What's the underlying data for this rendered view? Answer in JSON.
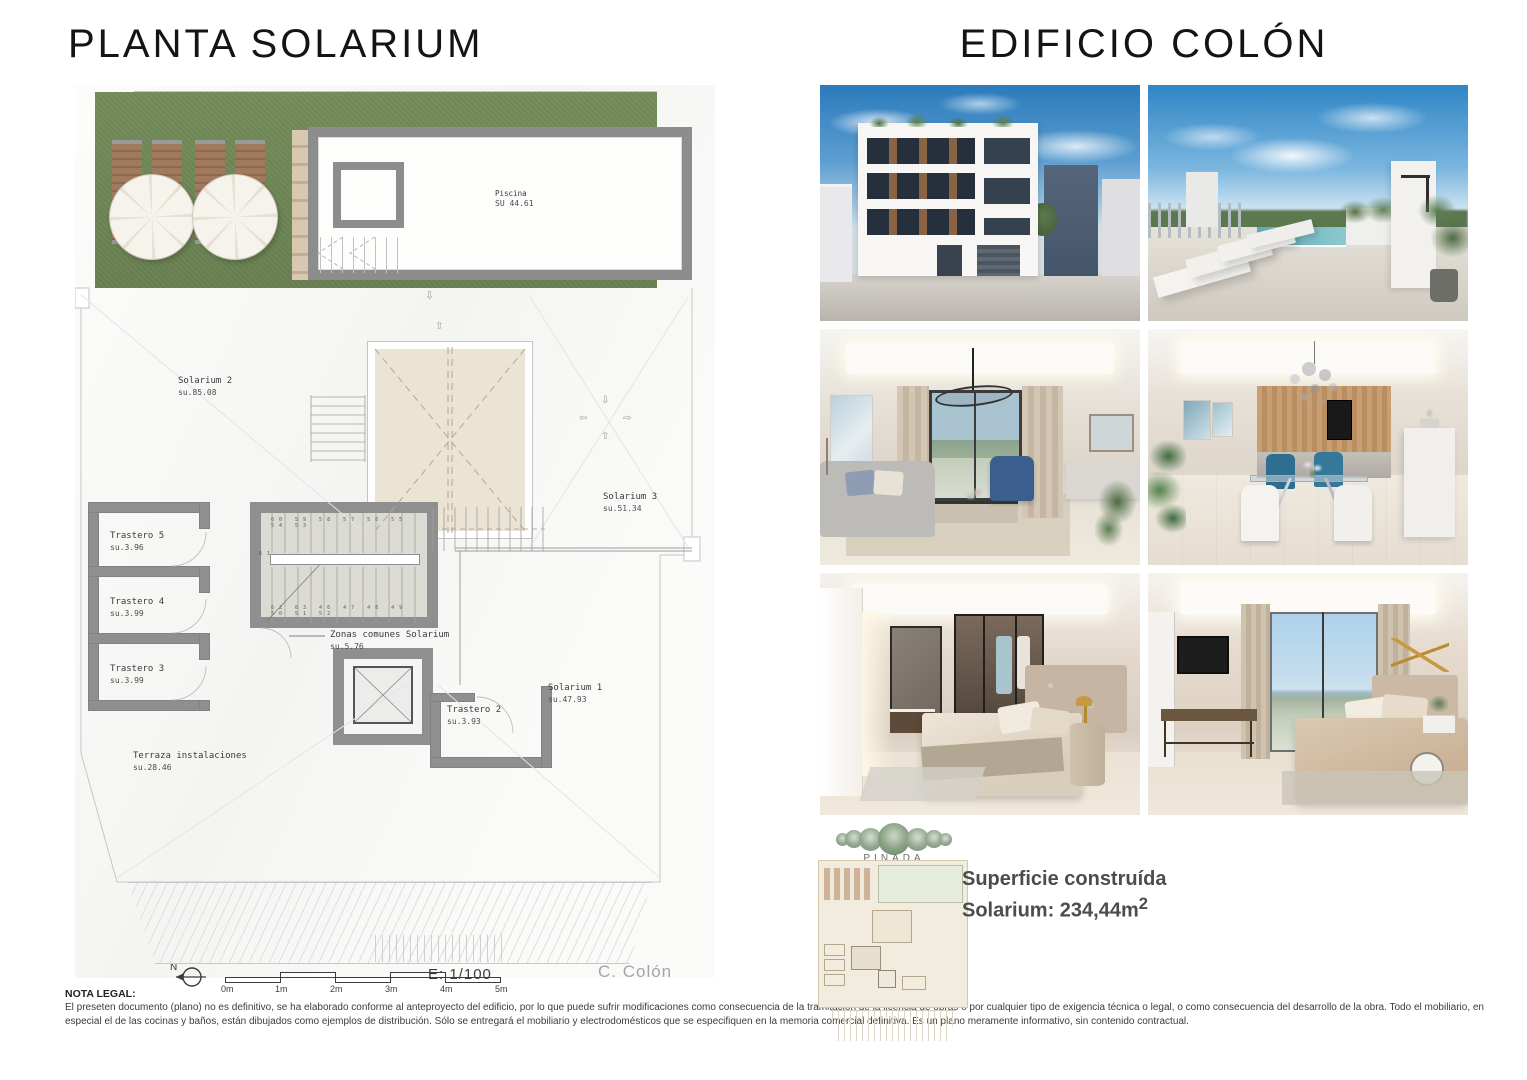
{
  "left_page": {
    "title": "PLANTA SOLARIUM",
    "plan": {
      "labels": {
        "piscina": {
          "name": "Piscina",
          "area": "SU 44.61"
        },
        "solarium2": {
          "name": "Solarium 2",
          "area": "su.85.08"
        },
        "solarium3": {
          "name": "Solarium 3",
          "area": "su.51.34"
        },
        "solarium1": {
          "name": "Solarium 1",
          "area": "su.47.93"
        },
        "trastero5": {
          "name": "Trastero 5",
          "area": "su.3.96"
        },
        "trastero4": {
          "name": "Trastero 4",
          "area": "su.3.99"
        },
        "trastero3": {
          "name": "Trastero 3",
          "area": "su.3.99"
        },
        "trastero2": {
          "name": "Trastero 2",
          "area": "su.3.93"
        },
        "zonas_comunes": {
          "name": "Zonas comunes Solarium",
          "area": "su.5.76"
        },
        "terraza": {
          "name": "Terraza instalaciones",
          "area": "su.28.46"
        }
      },
      "stairs": {
        "upper_run": "60 59 58 57 56 55 54 53",
        "mid_step": "61",
        "lower_run": "62 63 46 47 48 49 50 51 52"
      },
      "compass_label": "N",
      "scale": {
        "ticks": [
          "0m",
          "1m",
          "2m",
          "3m",
          "4m",
          "5m"
        ],
        "ratio_label": "E: 1/100"
      },
      "credit": "C. Colón"
    },
    "legal": {
      "title": "NOTA LEGAL:",
      "body": "El preseten documento (plano) no es definitivo, se ha elaborado conforme al anteproyecto del edificio, por lo que puede sufrir modificaciones como consecuencia de la tramitación de la licencia de obras o por cualquier tipo de exigencia técnica o legal, o como consecuencia del desarrollo de la obra. Todo el mobiliario, en especial el de las cocinas y baños, están dibujados como ejemplos de distribución. Sólo se entregará el mobiliario y electrodomésticos que se especifiquen en la memoria comercial definitiva. Es un plano meramente informativo, sin contenido contractual."
    }
  },
  "right_page": {
    "title": "EDIFICIO COLÓN",
    "photos": [
      {
        "name": "exterior-edificio"
      },
      {
        "name": "solarium-piscina"
      },
      {
        "name": "salon"
      },
      {
        "name": "comedor-cocina"
      },
      {
        "name": "dormitorio-vestidor"
      },
      {
        "name": "dormitorio-vistas"
      }
    ],
    "logo_text": "PINADA",
    "summary": {
      "line1": "Superficie construída",
      "line2": "Solarium: 234,44m",
      "line2_sup": "2"
    }
  },
  "palette": {
    "lawn_green": "#73885c",
    "wall_gray": "#8f8f8f",
    "skylight_beige": "#ebe3d3",
    "sky_blue": "#2f86c6",
    "summary_text": "#4c4c4c",
    "logo_green": "#93a88f"
  }
}
